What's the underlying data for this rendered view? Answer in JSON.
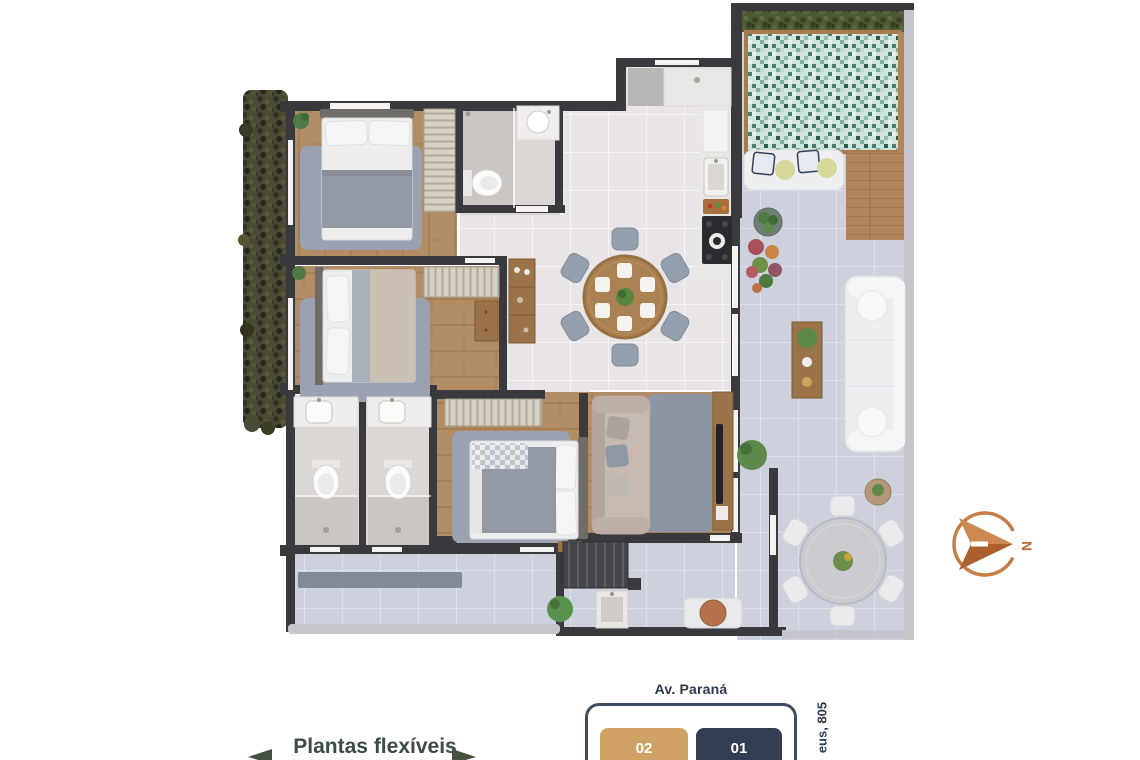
{
  "footer": {
    "flexible_plans_label": "Plantas flexíveis",
    "street_top_label": "Av. Paraná",
    "street_side_label": "eus, 805",
    "units": [
      {
        "number": "02",
        "color": "#d0a266",
        "text_color": "#ffffff"
      },
      {
        "number": "01",
        "color": "#323e51",
        "text_color": "#ffffff"
      }
    ]
  },
  "compass": {
    "label": "N",
    "color": "#c1753d"
  },
  "palette": {
    "wall": "#3a3a3e",
    "wood_floor": "#b28c64",
    "tile_floor": "#e8e4e7",
    "terrace_floor": "#ccd1dd",
    "pool_green": "#7fae9d",
    "hedge_green": "#4d5a33",
    "accent_orange": "#c1753d",
    "navy": "#2c3a50",
    "tan": "#d0a266",
    "arrow_green": "#44523f"
  }
}
